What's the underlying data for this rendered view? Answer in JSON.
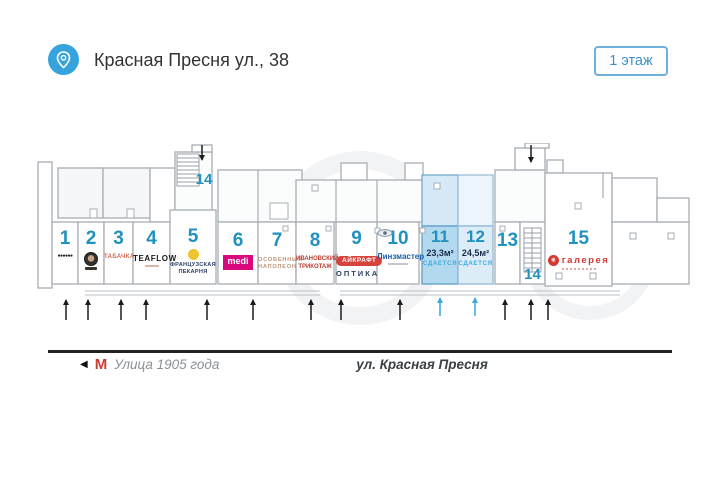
{
  "header": {
    "title": "Красная Пресня ул., 38",
    "floor_badge": "1 этаж"
  },
  "plan": {
    "units": [
      {
        "number": "1",
        "logo_glyph": "●●●●●●"
      },
      {
        "number": "2"
      },
      {
        "number": "3",
        "tenant": "ТАБАЧКА"
      },
      {
        "number": "4",
        "tenant": "TEAFLOW"
      },
      {
        "number": "5",
        "tenant_line1": "ФРАНЦУЗСКАЯ",
        "tenant_line2": "ПЕКАРНЯ"
      },
      {
        "number": "6",
        "tenant": "medi"
      },
      {
        "number": "7",
        "tenant_line1": "ОСОБЕННЫЙ",
        "tenant_line2": "НАПОЛЕОН"
      },
      {
        "number": "8",
        "tenant_line1": "ИВАНОВСКИЙ",
        "tenant_line2": "ТРИКОТАЖ"
      },
      {
        "number": "9",
        "tenant": "АЙКРАФТ",
        "tenant_sub": "ОПТИКА"
      },
      {
        "number": "10",
        "tenant": "Линзмастер"
      },
      {
        "number": "11",
        "area": "23,3м²",
        "status": "СДАЕТСЯ"
      },
      {
        "number": "12",
        "area": "24,5м²",
        "status": "СДАЕТСЯ"
      },
      {
        "number": "13"
      },
      {
        "number": "14"
      },
      {
        "number": "15",
        "tenant": "галерея",
        "icon_glyph": "❋"
      }
    ]
  },
  "street": {
    "direction_arrow": "◀",
    "metro_symbol": "М",
    "metro_station": "Улица 1905 года",
    "street_name": "ул. Красная Пресня"
  },
  "colors": {
    "accent_blue": "#2191c0",
    "rent_unit_fill": "#b3d9ef",
    "rent_unit_fill_light": "#dcedf8",
    "status_text": "#41abdf",
    "metro_red": "#cf3a35",
    "header_pin": "#37a3dd"
  }
}
